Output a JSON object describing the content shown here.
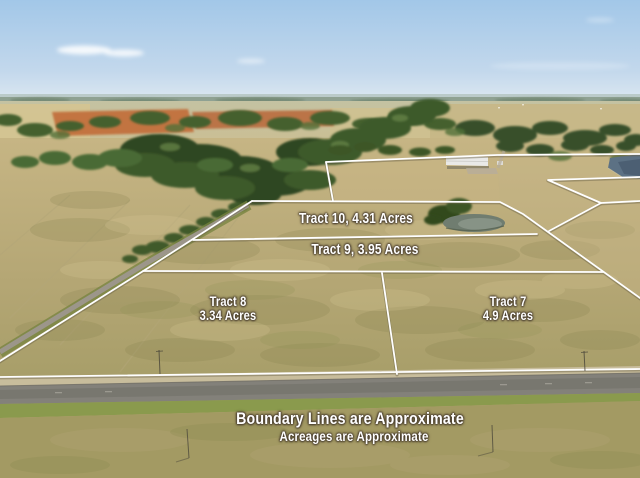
{
  "tracts": [
    {
      "name": "Tract 10",
      "acres": "4.31",
      "label": "Tract 10, 4.31 Acres"
    },
    {
      "name": "Tract 9",
      "acres": "3.95",
      "label": "Tract 9, 3.95 Acres"
    },
    {
      "name": "Tract 8",
      "acres": "3.34",
      "label_line1": "Tract 8",
      "label_line2": "3.34 Acres"
    },
    {
      "name": "Tract 7",
      "acres": "4.9",
      "label_line1": "Tract 7",
      "label_line2": "4.9 Acres"
    }
  ],
  "disclaimer": {
    "line1": "Boundary Lines are Approximate",
    "line2": "Acreages are Approximate"
  },
  "colors": {
    "sky": "#a9cbe8",
    "field_tan": "#b9a975",
    "field_olive": "#9a9258",
    "tree_green": "#3c5628",
    "plowed_field_orange": "#c2703c",
    "road_gray": "#83817a",
    "boundary_line": "#ffffff",
    "label_text": "#ffffff",
    "pond_water": "#707d70",
    "lake_water": "#5c7184"
  }
}
